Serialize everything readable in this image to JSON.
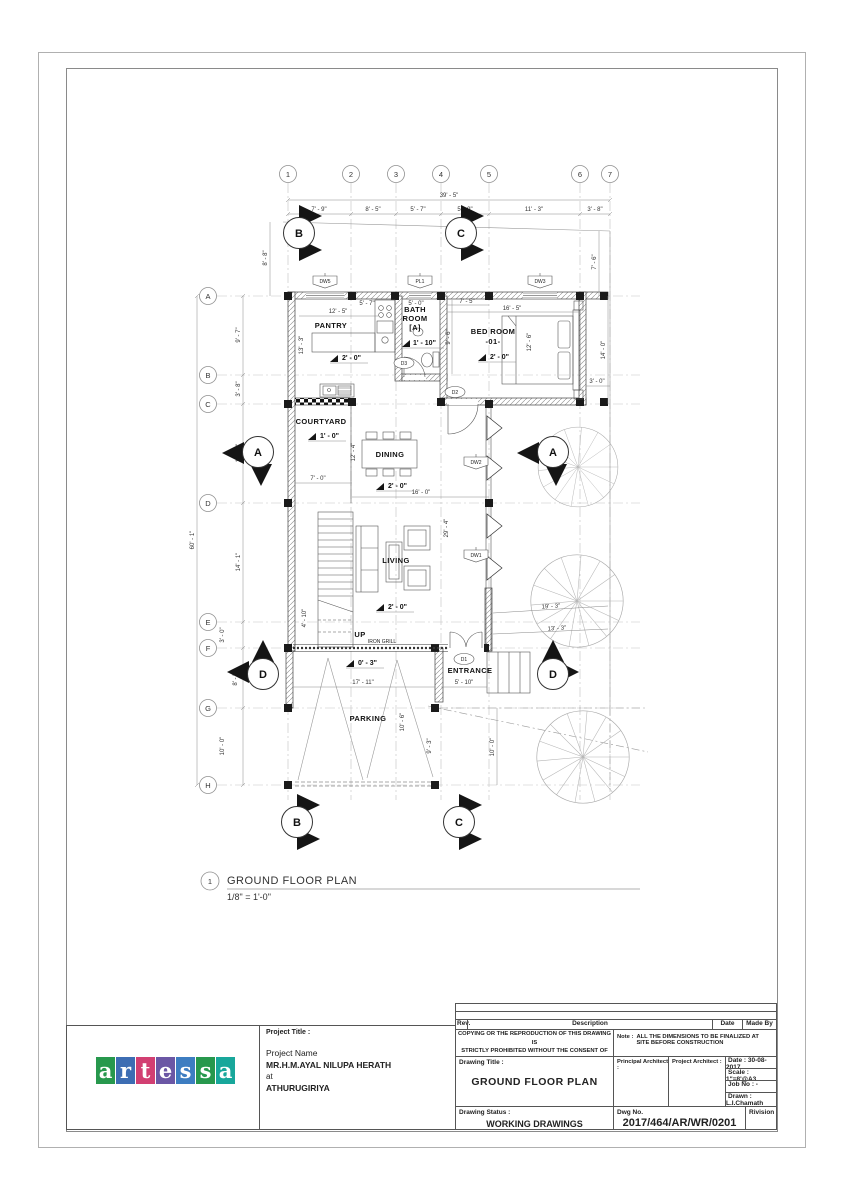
{
  "sheet": {
    "number": "1",
    "title": "GROUND FLOOR PLAN",
    "scale": "1/8\" = 1'-0\""
  },
  "grid_cols": [
    "1",
    "2",
    "3",
    "4",
    "5",
    "6",
    "7"
  ],
  "grid_rows": [
    "A",
    "B",
    "C",
    "D",
    "E",
    "F",
    "G",
    "H"
  ],
  "section_markers": {
    "top_b": "B",
    "top_c": "C",
    "left_a": "A",
    "right_a": "A",
    "left_d": "D",
    "right_d": "D",
    "bottom_b": "B",
    "bottom_c": "C"
  },
  "dims": {
    "top_overall": "39' - 5\"",
    "top_segments": [
      "7' - 9\"",
      "8' - 5\"",
      "5' - 7\"",
      "5' - 9\"",
      "11' - 3\"",
      "3' - 8\""
    ],
    "left_overall": "60' - 1\"",
    "left_segments": [
      "9' - 7\"",
      "3' - 8\"",
      "13' - 0\"",
      "14' - 1\"",
      "3' - 0\"",
      "8' - 5\"",
      "10' - 0\""
    ],
    "left_offset": "8' - 8\"",
    "right_offset": "7' - 6\"",
    "bedroom_side": "14' - 0\"",
    "bedroom_corner": "3' - 0\"",
    "pantry_width": "12' - 5\"",
    "pantry_depth": "13' - 3\"",
    "pantry_counter": "5' - 7\"",
    "bath_width": "5' - 0\"",
    "bedroom_entry": "7' - 5\"",
    "bedroom_width": "16' - 5\"",
    "bedroom_depth": "12' - 6\"",
    "hall_depth": "9' - 6\"",
    "courtyard_width": "7' - 0\"",
    "dining_width": "16' - 0\"",
    "dining_depth": "12' - 4\"",
    "living_depth": "29' - 4\"",
    "stair_width": "4' - 10\"",
    "grill_width": "17' - 11\"",
    "entrance_width": "5' - 10\"",
    "parking_depth": "10' - 6\"",
    "parking_side": "9' - 3\"",
    "yard_depth": "10' - 0\"",
    "boundary_1": "19' - 3\"",
    "boundary_2": "13' - 3\""
  },
  "levels": {
    "pantry": "2' - 0\"",
    "bath": "1' - 10\"",
    "bedroom": "2' - 0\"",
    "courtyard": "1' - 0\"",
    "dining": "2' - 0\"",
    "living": "2' - 0\"",
    "entrance": "0' - 3\""
  },
  "rooms": {
    "pantry": "PANTRY",
    "bath_1": "BATH",
    "bath_2": "ROOM",
    "bath_3": "[A]",
    "bedroom_1": "BED ROOM",
    "bedroom_2": "-01-",
    "courtyard": "COURTYARD",
    "dining": "DINING",
    "living": "LIVING",
    "up": "UP",
    "iron_grill": "IRON GRILL",
    "entrance": "ENTRANCE",
    "parking": "PARKING"
  },
  "openings": {
    "dw5": "DW5",
    "pl1": "PL1",
    "dw3": "DW3",
    "d3": "D3",
    "d2": "D2",
    "dw2": "DW2",
    "dw1": "DW1",
    "d1": "D1"
  },
  "title_block": {
    "rev": "Rev.",
    "description": "Description",
    "date": "Date",
    "made_by": "Made By",
    "copyright_1": "COPYING OR THE REPRODUCTION OF THIS DRAWING IS",
    "copyright_2": "STRICTLY PROHIBITED WITHOUT THE CONSENT OF",
    "note_label": "Note :",
    "note_text": "ALL THE DIMENSIONS TO BE FINALIZED AT SITE BEFORE CONSTRUCTION",
    "project_title_label": "Project Title :",
    "project_name_label": "Project Name",
    "client": "MR.H.M.AYAL NILUPA HERATH",
    "at": "at",
    "location": "ATHURUGIRIYA",
    "drawing_title_label": "Drawing Title :",
    "drawing_title": "GROUND FLOOR PLAN",
    "principal_architect_label": "Principal Architect :",
    "project_architect_label": "Project Architect :",
    "date_value": "Date : 30-08-2017",
    "scale_value": "Scale : 1\"=8'@A3",
    "job_no": "Job No : -",
    "drawn": "Drawn : L.I.Chamath",
    "drawing_status_label": "Drawing Status :",
    "drawing_status": "WORKING DRAWINGS",
    "dwg_no_label": "Dwg No.",
    "dwg_no": "2017/464/AR/WR/0201",
    "revision_label": "Rivision"
  },
  "logo": {
    "blocks": [
      {
        "ch": "a",
        "bg": "#27984d"
      },
      {
        "ch": "r",
        "bg": "#3d6db3"
      },
      {
        "ch": "t",
        "bg": "#d23f72"
      },
      {
        "ch": "e",
        "bg": "#6b57a5"
      },
      {
        "ch": "s",
        "bg": "#3d7dc1"
      },
      {
        "ch": "s",
        "bg": "#27984d"
      },
      {
        "ch": "a",
        "bg": "#18a79b"
      }
    ]
  }
}
